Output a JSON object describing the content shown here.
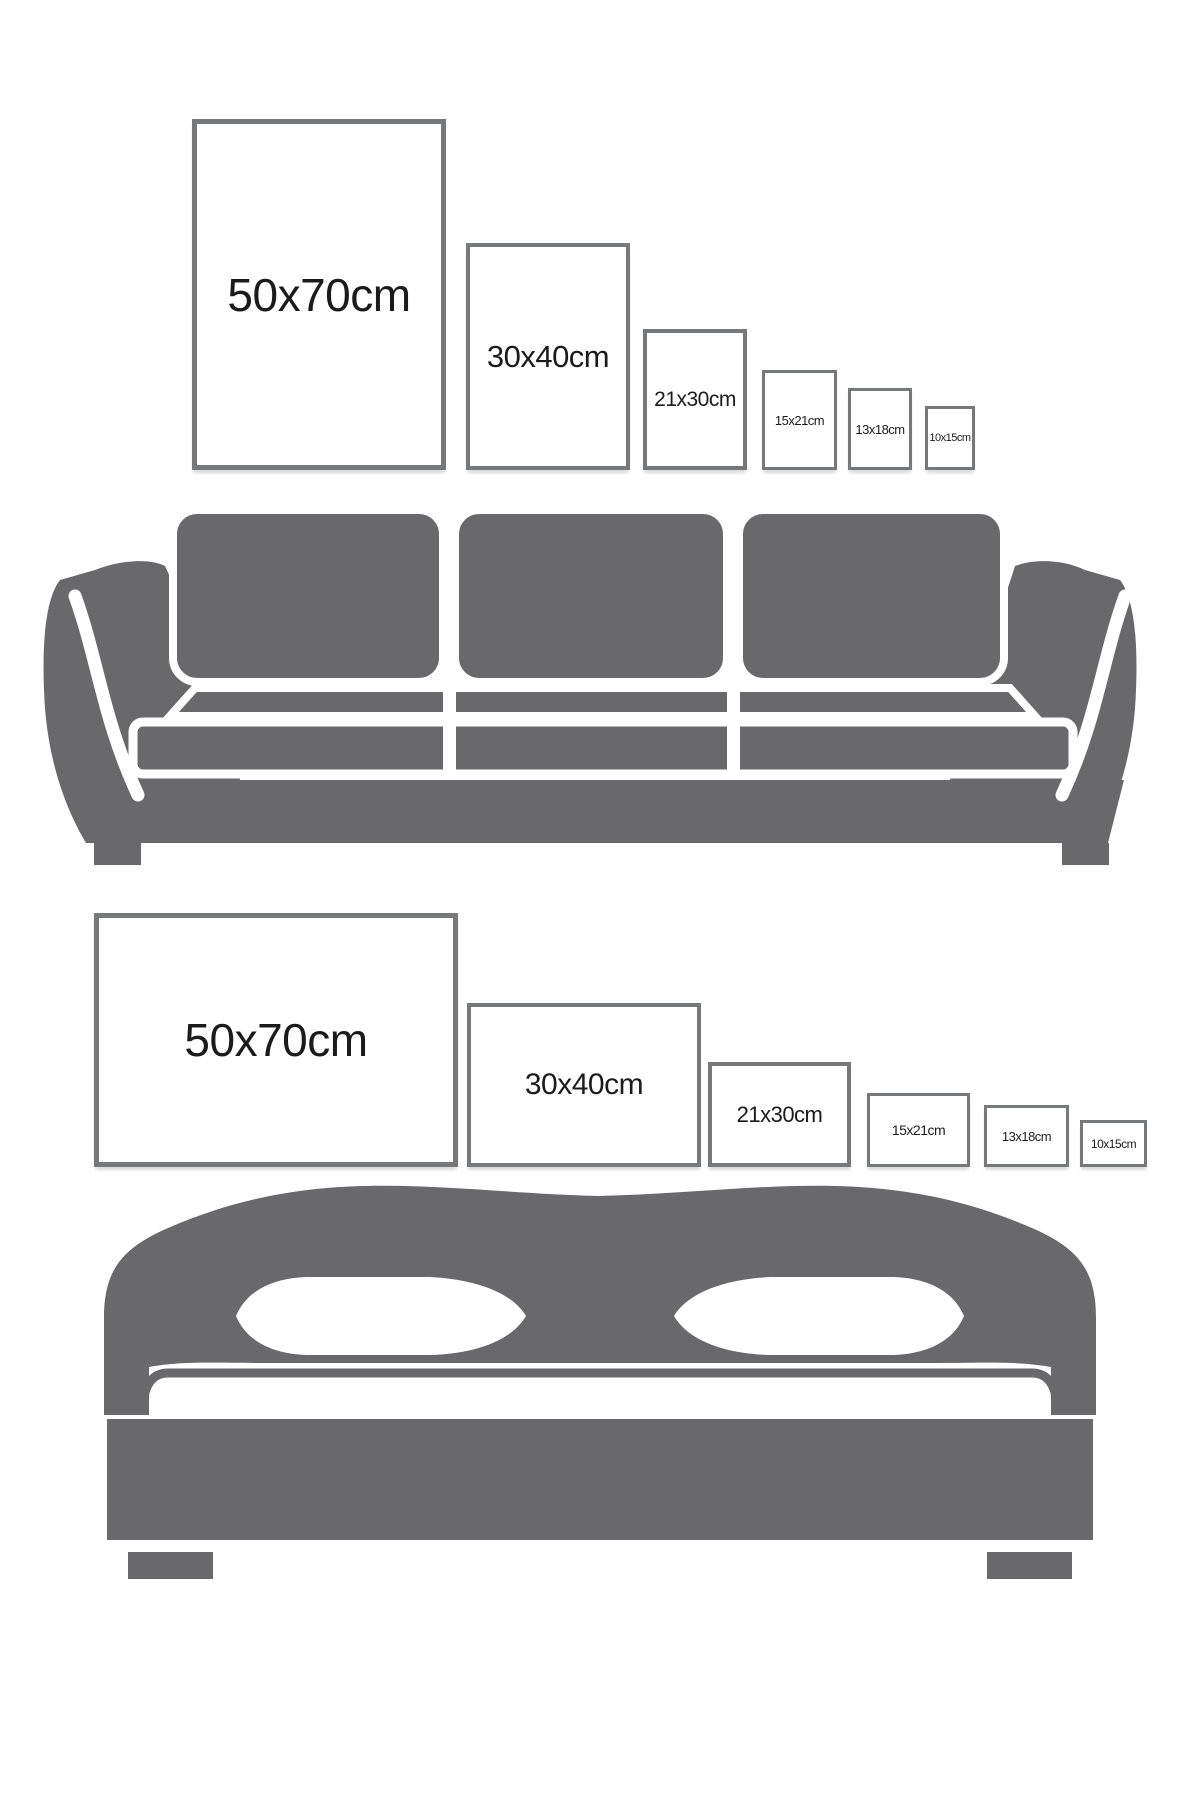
{
  "colors": {
    "furniture_gray": "#69696b",
    "frame_border": "#77787a",
    "label_text": "#1b1b1b",
    "background": "#ffffff",
    "separator_white": "#ffffff"
  },
  "rows": [
    {
      "name": "portrait-frames-above-sofa",
      "orientation": "portrait",
      "frames": [
        {
          "label": "50x70cm"
        },
        {
          "label": "30x40cm"
        },
        {
          "label": "21x30cm"
        },
        {
          "label": "15x21cm"
        },
        {
          "label": "13x18cm"
        },
        {
          "label": "10x15cm"
        }
      ]
    },
    {
      "name": "landscape-frames-above-bed",
      "orientation": "landscape",
      "frames": [
        {
          "label": "50x70cm"
        },
        {
          "label": "30x40cm"
        },
        {
          "label": "21x30cm"
        },
        {
          "label": "15x21cm"
        },
        {
          "label": "13x18cm"
        },
        {
          "label": "10x15cm"
        }
      ]
    }
  ],
  "illustrations": [
    {
      "name": "sofa",
      "description": "three-seat sofa silhouette"
    },
    {
      "name": "bed",
      "description": "double bed with arched headboard silhouette"
    }
  ]
}
